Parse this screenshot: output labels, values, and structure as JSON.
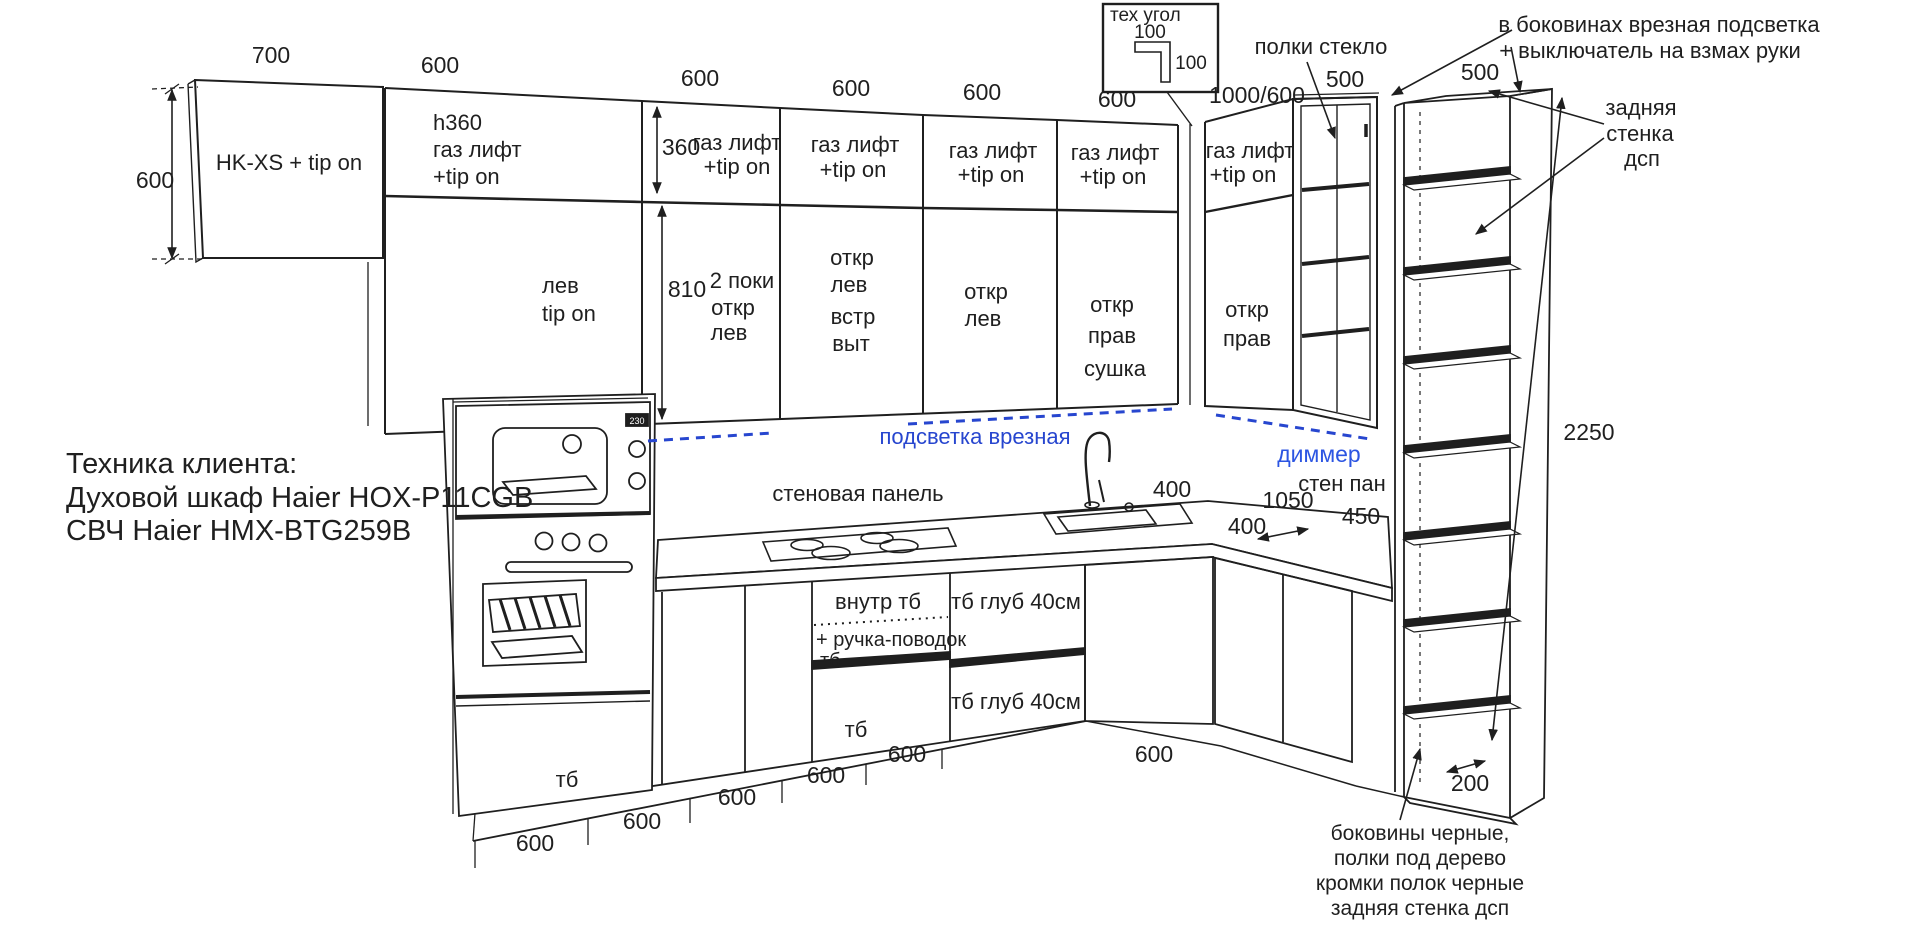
{
  "colors": {
    "ink": "#1f1f1f",
    "blue": "#2746cf",
    "dimmer_blue": "#2c55e2",
    "background": "#ffffff"
  },
  "client": {
    "l1": "Техника клиента:",
    "l2": "Духовой шкаф Haier HOX-P11CGB",
    "l3": "СВЧ Haier HMX-BTG259B"
  },
  "tech_corner": {
    "title": "тех угол",
    "dim_top": "100",
    "dim_side": "100"
  },
  "dims": {
    "hk_w": "700",
    "hk_h": "600",
    "top": [
      "600",
      "600",
      "600",
      "600",
      "600"
    ],
    "corner": "1000/600",
    "glass": "500",
    "shelf": "500",
    "row_top": "360",
    "row_bottom": "810",
    "sink": "400",
    "right1050": "1050",
    "right450": "450",
    "right400": "400",
    "shelf_h": "2250",
    "shelf_d": "200",
    "bottom": [
      "600",
      "600",
      "600",
      "600",
      "600"
    ],
    "bottom_right": "600"
  },
  "cabinets": {
    "hkxs": "HK-XS + tip on",
    "a_top": [
      "h360",
      "газ лифт",
      "+tip on"
    ],
    "a_bot": [
      "лев",
      "tip on"
    ],
    "top_row": [
      "газ лифт",
      "+tip on"
    ],
    "b_bot": [
      "2 поки",
      "откр",
      "лев"
    ],
    "c_bot": [
      "откр",
      "лев",
      "встр",
      "выт"
    ],
    "d_bot": [
      "откр",
      "лев"
    ],
    "e_bot": [
      "откр",
      "прав",
      "сушка"
    ],
    "f_bot": [
      "откр",
      "прав"
    ]
  },
  "annotations": {
    "glass_shelves": "полки стекло",
    "side_light1": "в боковинах врезная подсветка",
    "side_light2": "+ выключатель на взмах руки",
    "back_wall": [
      "задняя",
      "стенка",
      "дсп"
    ],
    "strip_light": "подсветка врезная",
    "dimmer": "диммер",
    "wall_panel": "стеновая панель",
    "wall_panel_short": "стен пан",
    "footer": [
      "боковины черные,",
      "полки под дерево",
      "кромки полок черные",
      "задняя стенка дсп"
    ]
  },
  "base": {
    "inner": "внутр тб",
    "handle": "+ ручка-поводок",
    "handle2": "тб",
    "tb_mid": "тб",
    "tb_oven": "тб",
    "depth1": "тб глуб 40см",
    "depth2": "тб глуб 40см"
  },
  "appliances": {
    "mw_display": "230"
  }
}
